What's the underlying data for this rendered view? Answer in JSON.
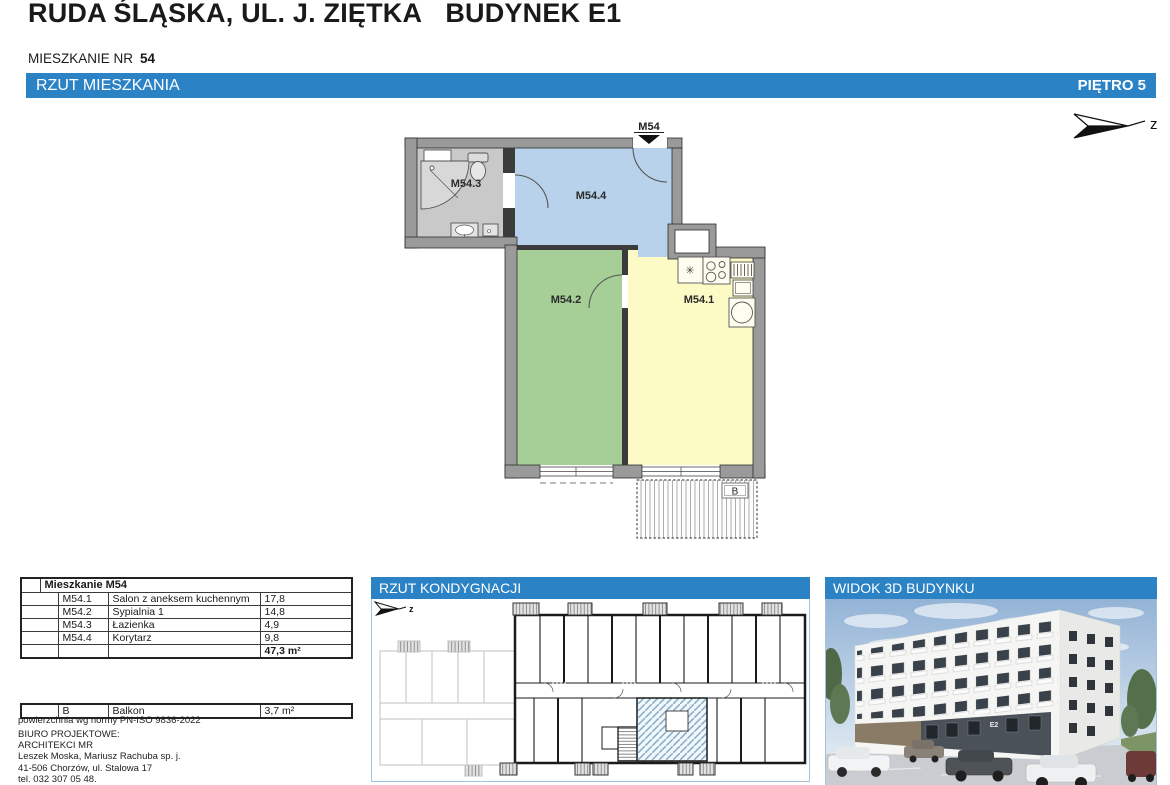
{
  "page": {
    "title": "RUDA ŚLĄSKA, UL. J. ZIĘTKA   BUDYNEK E1",
    "apartment_label": "MIESZKANIE NR",
    "apartment_number": "54"
  },
  "main_bar": {
    "left_title": "RZUT MIESZKANIA",
    "right_title": "PIĘTRO 5"
  },
  "compass": {
    "letter": "z"
  },
  "floor_plan": {
    "entrance_label": "M54",
    "balcony_label": "B",
    "room_labels": {
      "m54_1": "M54.1",
      "m54_2": "M54.2",
      "m54_3": "M54.3",
      "m54_4": "M54.4"
    },
    "room_colors": {
      "living": "#fcfac5",
      "bedroom": "#a6cf97",
      "bathroom": "#c9c9c9",
      "hall": "#b7d2ea"
    }
  },
  "area_table": {
    "title": "Mieszkanie M54",
    "rows": [
      {
        "code": "M54.1",
        "name": "Salon z aneksem kuchennym",
        "area": "17,8"
      },
      {
        "code": "M54.2",
        "name": "Sypialnia 1",
        "area": "14,8"
      },
      {
        "code": "M54.3",
        "name": "Łazienka",
        "area": "4,9"
      },
      {
        "code": "M54.4",
        "name": "Korytarz",
        "area": "9,8"
      }
    ],
    "total": "47,3 m²"
  },
  "balcony_row": {
    "code": "B",
    "name": "Balkon",
    "area": "3,7 m²"
  },
  "footer": {
    "norm_note": "powierzchnia wg normy PN-ISO 9836-2022",
    "office_label": "BIURO PROJEKTOWE:",
    "office_lines": [
      "ARCHITEKCI MR",
      "Leszek Moska, Mariusz Rachuba sp. j.",
      "41-506 Chorzów, ul. Stalowa 17",
      "tel. 032 307 05 48."
    ]
  },
  "panels": {
    "floor_plan_panel": {
      "title": "RZUT KONDYGNACJI"
    },
    "view3d_panel": {
      "title": "WIDOK 3D BUDYNKU",
      "building_sign": "E2"
    }
  },
  "colors": {
    "accent_blue": "#2b82c5"
  }
}
